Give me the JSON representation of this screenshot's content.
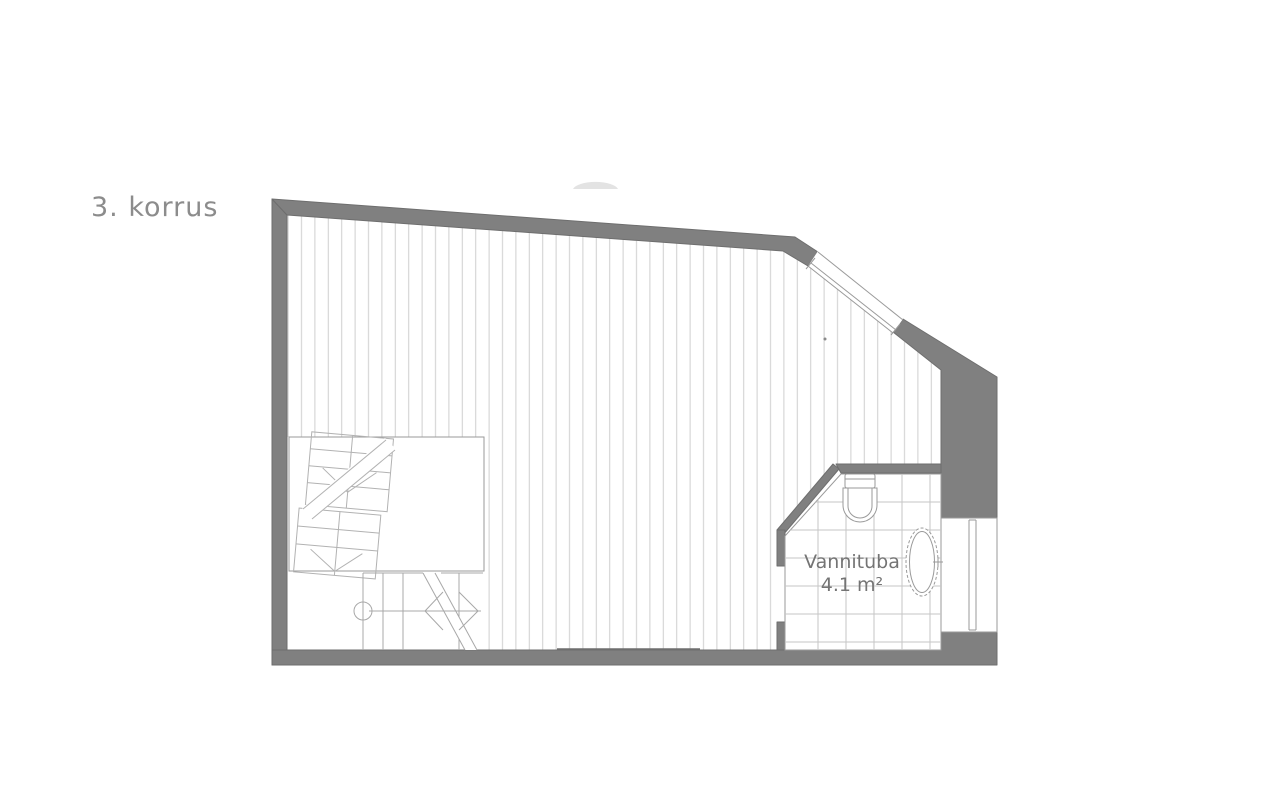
{
  "page": {
    "width": 1268,
    "height": 800,
    "background": "#ffffff"
  },
  "floor_label": "3. korrus",
  "rooms": [
    {
      "name": "Vannituba",
      "area_label": "4.1 m²"
    }
  ],
  "diagram": {
    "type": "floor-plan",
    "floor_number": "3",
    "elements": [
      "exterior-walls",
      "wood-floor-hatching",
      "stairwell-opening",
      "switchback-staircase",
      "lower-stair-flight",
      "bathroom",
      "bathroom-door-opening",
      "toilet",
      "oval-bathtub",
      "bathtub-faucet",
      "diagonal-window",
      "right-wall-window",
      "dome-shape"
    ]
  },
  "colors": {
    "wall": "#808080",
    "wall_outline": "#6e6e6e",
    "hatch_line": "#cdcdcd",
    "tile_line": "#c6c6c6",
    "fixture_line": "#9a9a9a",
    "stair_line": "#b2b2b2",
    "floor_label_text": "#8c8c8c",
    "room_label_text": "#747474",
    "dome_fill": "#e3e3e3"
  }
}
